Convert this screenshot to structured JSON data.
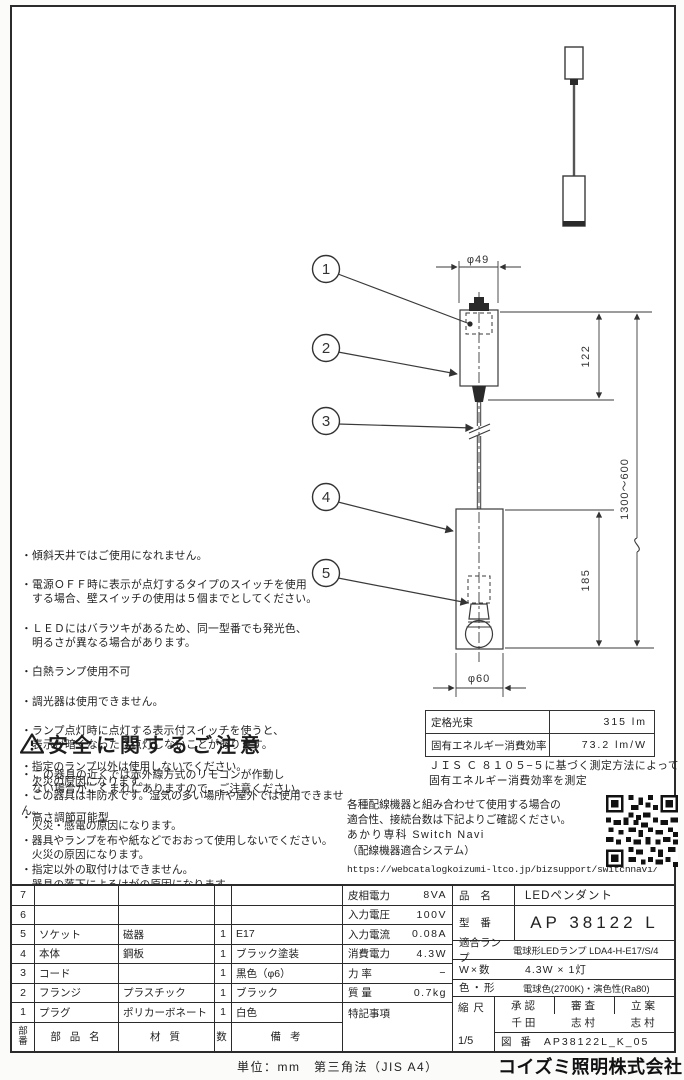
{
  "page": {
    "unit_note": "単位：mm　第三角法（JIS A4）",
    "company": "コイズミ照明株式会社"
  },
  "notes": {
    "items": [
      "・傾斜天井ではご使用になれません。",
      "・電源ＯＦＦ時に表示が点灯するタイプのスイッチを使用\n　する場合、壁スイッチの使用は５個までとしてください。",
      "・ＬＥＤにはバラツキがあるため、同一型番でも発光色、\n　明るさが異なる場合があります。",
      "・白熱ランプ使用不可",
      "・調光器は使用できません。",
      "・ランプ点灯時に点灯する表示付スイッチを使うと、\n　表示が暗くなったり点灯しないことがあります。",
      "・この器具の近くでは赤外線方式のリモコンが作動し\n　ない場合がごくまれにありますので、ご注意ください。",
      "・高さ調節可能型"
    ]
  },
  "safety": {
    "title": "安全に関するご注意",
    "items": [
      "・指定のランプ以外は使用しないでください。\n　火災の原因になります。",
      "・この器具は非防水です。湿気の多い場所や屋外では使用できません。\n　火災・感電の原因になります。",
      "・器具やランプを布や紙などでおおって使用しないでください。\n　火災の原因になります。",
      "・指定以外の取付けはできません。\n　器具の落下によるけがの原因になります。"
    ]
  },
  "photometrics": {
    "rows": [
      {
        "label": "定格光束",
        "value": "315 lm"
      },
      {
        "label": "固有エネルギー消費効率",
        "value": "73.2 lm/W"
      }
    ],
    "note": "ＪＩＳ Ｃ ８１０５−５に基づく測定方法によって\n固有エネルギー消費効率を測定"
  },
  "switch_navi": {
    "line1": "各種配線機器と組み合わせて使用する場合の",
    "line2": "適合性、接続台数は下記よりご確認ください。",
    "line3": "あかり専科 Switch Navi",
    "line4": "（配線機器適合システム）",
    "url": "https://webcatalogkoizumi-ltco.jp/bizsupport/switchnavi/"
  },
  "drawing": {
    "callouts": [
      "1",
      "2",
      "3",
      "4",
      "5"
    ],
    "dims": {
      "top_dia": "φ49",
      "body_h": "122",
      "overall": "1300〜600",
      "shade_h": "185",
      "shade_dia": "φ60"
    }
  },
  "parts_table": {
    "header": {
      "no": "部\n番",
      "name": "部 品 名",
      "material": "材  質",
      "qty": "数",
      "note": "備  考"
    },
    "rows": [
      {
        "no": "7",
        "name": "",
        "material": "",
        "qty": "",
        "note": ""
      },
      {
        "no": "6",
        "name": "",
        "material": "",
        "qty": "",
        "note": ""
      },
      {
        "no": "5",
        "name": "ソケット",
        "material": "磁器",
        "qty": "1",
        "note": "E17"
      },
      {
        "no": "4",
        "name": "本体",
        "material": "鋼板",
        "qty": "1",
        "note": "ブラック塗装"
      },
      {
        "no": "3",
        "name": "コード",
        "material": "",
        "qty": "1",
        "note": "黒色（φ6）"
      },
      {
        "no": "2",
        "name": "フランジ",
        "material": "プラスチック",
        "qty": "1",
        "note": "ブラック"
      },
      {
        "no": "1",
        "name": "プラグ",
        "material": "ポリカーボネート",
        "qty": "1",
        "note": "白色"
      }
    ]
  },
  "electric_table": {
    "rows": [
      {
        "label": "皮相電力",
        "value": "8VA"
      },
      {
        "label": "入力電圧",
        "value": "100V"
      },
      {
        "label": "入力電流",
        "value": "0.08A"
      },
      {
        "label": "消費電力",
        "value": "4.3W"
      },
      {
        "label": "力 率",
        "value": "−"
      },
      {
        "label": "質 量",
        "value": "0.7kg"
      }
    ],
    "notes_label": "特記事項"
  },
  "title_block": {
    "name_label": "品 名",
    "name": "LEDペンダント",
    "model_label": "型 番",
    "model": "AP 38122 L",
    "lamp_label": "適合ランプ",
    "lamp": "電球形LEDランプ LDA4-H-E17/S/4",
    "wattage_label": "W×数",
    "wattage": "4.3W × 1灯",
    "color_label": "色・形",
    "color": "電球色(2700K)・演色性(Ra80)",
    "scale_label": "縮 尺",
    "scale": "1/5",
    "approvals": [
      {
        "role": "承認",
        "name": "千田"
      },
      {
        "role": "審査",
        "name": "志村"
      },
      {
        "role": "立案",
        "name": "志村"
      }
    ],
    "zuban_label": "図 番",
    "zuban": "AP38122L_K_05"
  }
}
